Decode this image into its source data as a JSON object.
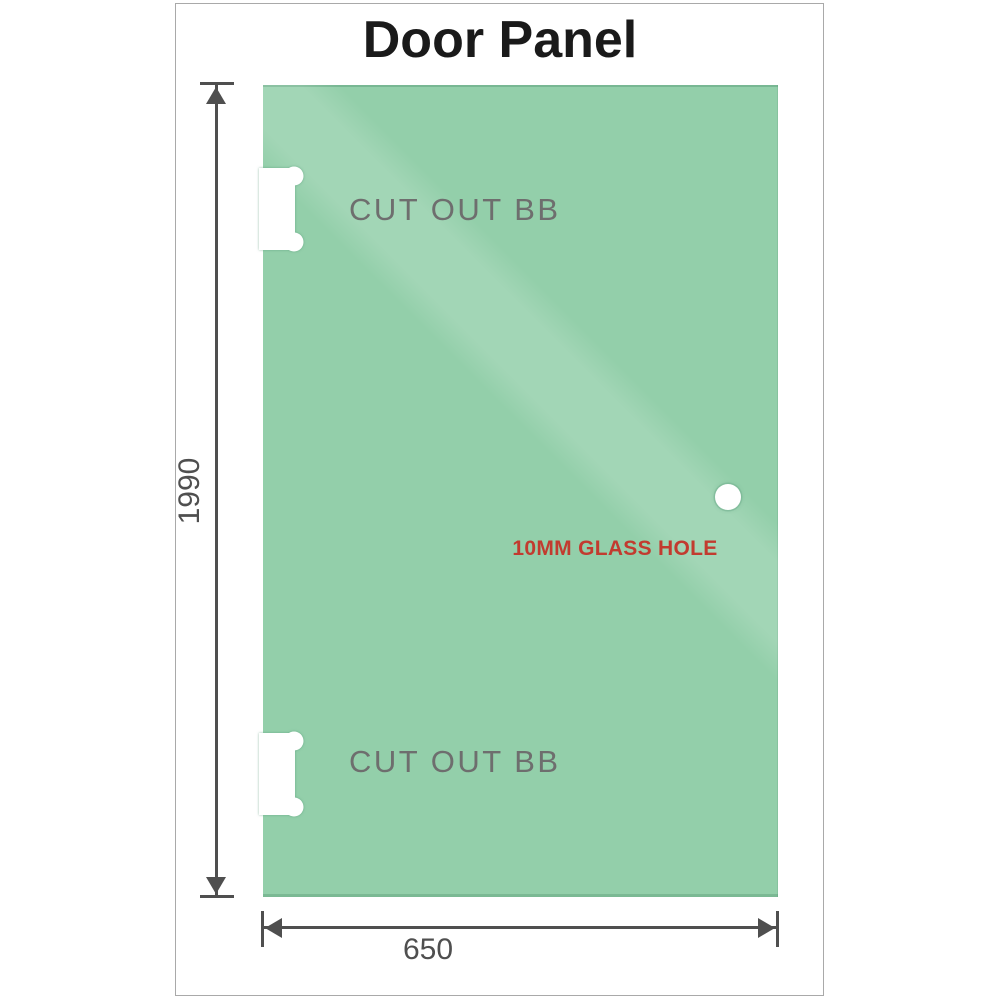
{
  "title": "Door Panel",
  "panel": {
    "cutouts": [
      {
        "label": "CUT OUT BB",
        "position": "top-left"
      },
      {
        "label": "CUT OUT BB",
        "position": "bottom-left"
      }
    ],
    "hole": {
      "label": "10MM GLASS HOLE"
    }
  },
  "dimensions": {
    "height": {
      "value": "1990",
      "orientation": "vertical"
    },
    "width": {
      "value": "650",
      "orientation": "horizontal"
    }
  },
  "colors": {
    "glass-dark": "#86c7a0",
    "glass-mid": "#93cfaa",
    "glass-light": "#b9e3c7",
    "glass-streak": "#abdcbd",
    "dim-line": "#4f4f4f",
    "label-gray": "#6e6e6e",
    "hole-red": "#c23b2f",
    "title-color": "#1a1a1a",
    "frame-border": "#a9a9a9"
  }
}
